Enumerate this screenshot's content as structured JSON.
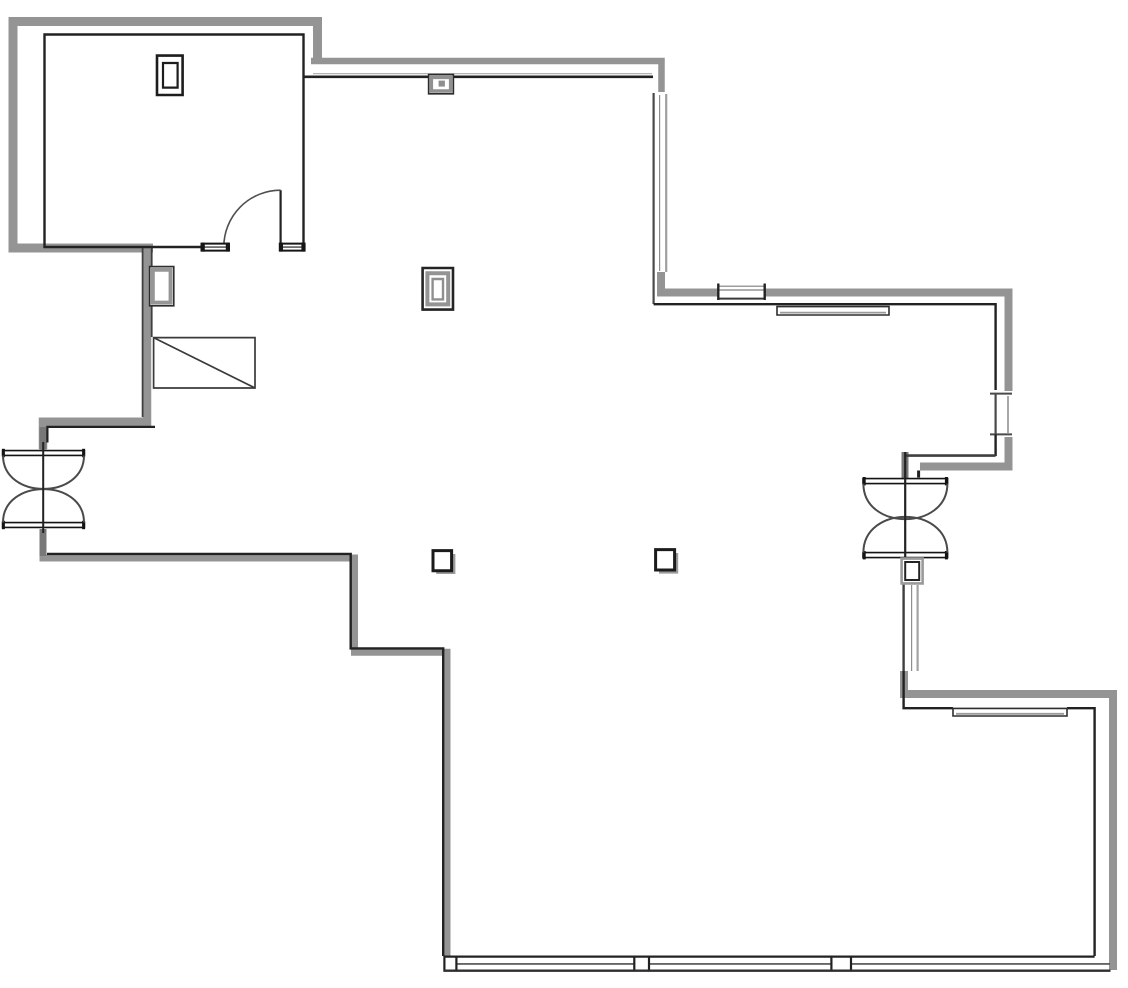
{
  "floorplan": {
    "viewBox": "0 0 1128 988",
    "width": 1128,
    "height": 988,
    "background": "#ffffff",
    "colors": {
      "wall_gray": "#949494",
      "wall_gray_dark": "#787878",
      "line_black": "#222222",
      "line_dark": "#3f3f3f",
      "line_light": "#b3b3b3",
      "shadow_gray": "#9c9c9c",
      "white": "#ffffff"
    },
    "paths": [
      {
        "name": "room-outer-wall-gray",
        "d": "M317.5,59 L317.5,21.5 L13,21.5 L13,248 L153,248",
        "stroke": "#949494",
        "w": 9
      },
      {
        "name": "corridor-top-wall-gray",
        "d": "M311,61 L661.5,61 L661.5,92",
        "stroke": "#949494",
        "w": 6.5
      },
      {
        "name": "window-topright-corner-gray",
        "d": "M661,272 L661,292.5 L718,292.5",
        "stroke": "#949494",
        "w": 8
      },
      {
        "name": "right-upper-band-gray",
        "d": "M765,292.5 L1008.5,292.5 L1008.5,391",
        "stroke": "#949494",
        "w": 8
      },
      {
        "name": "right-mid-corner-gray",
        "d": "M1008.5,437 L1008.5,466.5 L920,466.5",
        "stroke": "#949494",
        "w": 8
      },
      {
        "name": "right-lower-corner-gray",
        "d": "M904,671 L904,694 L1113,694 L1113,970",
        "stroke": "#949494",
        "w": 8
      },
      {
        "name": "left-upper-wall-gray",
        "d": "M147,248 L147,421.7 L43,421.7 L43,449",
        "stroke": "#949494",
        "w": 8.5
      },
      {
        "name": "left-lower-wall-gray",
        "d": "M43,531 L43,558 L354.5,558 L354.5,652.3 L447,652.3 L447,956",
        "stroke": "#949494",
        "w": 7
      },
      {
        "name": "right-door-top-stub-gray",
        "d": "M905,452 L905,478",
        "stroke": "#787878",
        "w": 7
      },
      {
        "name": "left-door-top-stub-gray",
        "d": "M43,427 L43,449.5",
        "stroke": "#787878",
        "w": 7
      },
      {
        "name": "left-door-bottom-stub-gray",
        "d": "M43,529 L43,556",
        "stroke": "#787878",
        "w": 7
      },
      {
        "name": "corridor-inner-light-line",
        "d": "M313,73.6 L652,73.6",
        "stroke": "#b3b3b3",
        "w": 1.3
      },
      {
        "name": "window-topright-line-right",
        "d": "M666.2,94 L666.2,272",
        "stroke": "#9e9e9e",
        "w": 2.2
      },
      {
        "name": "window-topright-line-mid",
        "d": "M659.6,95 L659.6,271",
        "stroke": "#8e8e8e",
        "w": 1.2
      },
      {
        "name": "window-top-line-a",
        "d": "M719,286.2 L765,286.2",
        "stroke": "#7f7f7f",
        "w": 1.2
      },
      {
        "name": "window-top-line-b",
        "d": "M719,290 L765,290",
        "stroke": "#7f7f7f",
        "w": 1.2
      },
      {
        "name": "window-rightmid-line-light",
        "d": "M1008,396 L1008,433",
        "stroke": "#a8a8a8",
        "w": 2
      },
      {
        "name": "window-rightlow-line-right",
        "d": "M917.6,585 L917.6,671",
        "stroke": "#a3a3a3",
        "w": 2.2
      },
      {
        "name": "window-rightlow-line-mid",
        "d": "M911.6,585 L911.6,671",
        "stroke": "#8e8e8e",
        "w": 1.2
      },
      {
        "name": "room-inner-wall-black",
        "d": "M201,247 L44.5,247 L44.5,34.5 L303.5,34.5 L303.5,247",
        "stroke": "#222222",
        "w": 2.4
      },
      {
        "name": "corridor-inner-black-west",
        "d": "M303.5,76.8 L429,76.8",
        "stroke": "#222222",
        "w": 2.6
      },
      {
        "name": "corridor-inner-black-east",
        "d": "M452.5,76.8 L653,76.8",
        "stroke": "#222222",
        "w": 2.6
      },
      {
        "name": "window-topright-line-dark",
        "d": "M653.6,93 L653.6,304",
        "stroke": "#4a4a4a",
        "w": 2.2
      },
      {
        "name": "right-upper-inner-black",
        "d": "M653.6,304.2 L995.6,304.2 L995.6,390",
        "stroke": "#222222",
        "w": 2.4
      },
      {
        "name": "window-top-line-bottom",
        "d": "M718,298.6 L765,298.6",
        "stroke": "#3a3a3a",
        "w": 2
      },
      {
        "name": "window-top-cap-left",
        "d": "M718.3,283.5 L718.3,300",
        "stroke": "#222222",
        "w": 2.4
      },
      {
        "name": "window-top-cap-right",
        "d": "M764.7,283.5 L764.7,300",
        "stroke": "#222222",
        "w": 2.4
      },
      {
        "name": "window-rightmid-line-dark",
        "d": "M995.6,394 L995.6,434",
        "stroke": "#4a4a4a",
        "w": 2.2
      },
      {
        "name": "window-rightmid-cap-top",
        "d": "M990,393.6 L1012,393.6",
        "stroke": "#4a4a4a",
        "w": 2
      },
      {
        "name": "window-rightmid-cap-bottom",
        "d": "M990,434.4 L1012,434.4",
        "stroke": "#4a4a4a",
        "w": 2
      },
      {
        "name": "window-rightmid-lower-black",
        "d": "M995.6,434.4 L995.6,456",
        "stroke": "#222222",
        "w": 2.4
      },
      {
        "name": "right-mid-inner-dark",
        "d": "M905,455.6 L995.6,455.6",
        "stroke": "#3f3f3f",
        "w": 2.6
      },
      {
        "name": "right-door-jamb-tick",
        "d": "M918.6,470.5 L918.6,477.5",
        "stroke": "#222222",
        "w": 3
      },
      {
        "name": "window-rightlow-line-dark",
        "d": "M903.6,584 L903.6,671",
        "stroke": "#3f3f3f",
        "w": 2.4
      },
      {
        "name": "bottomright-inner-black-west",
        "d": "M903.6,671 L903.6,708.2 L953,708.2",
        "stroke": "#222222",
        "w": 2.4
      },
      {
        "name": "bottomright-inner-black-east",
        "d": "M1067,708.2 L1094.6,708.2 L1094.6,956",
        "stroke": "#222222",
        "w": 2.4
      },
      {
        "name": "left-lower-inner-black",
        "d": "M47,553.9 L350.7,553.9 L350.7,648.4 L443.2,648.4 L443.2,956",
        "stroke": "#222222",
        "w": 2.4
      },
      {
        "name": "left-jog-inner-black",
        "d": "M155,426.9 L47.4,426.9 L47.4,442.5",
        "stroke": "#222222",
        "w": 2.2
      },
      {
        "name": "left-wall-west-edge",
        "d": "M142.6,248 L142.6,417",
        "stroke": "#3f3f3f",
        "w": 1.8
      },
      {
        "name": "left-wall-east-edge",
        "d": "M151.7,248 L151.7,337",
        "stroke": "#3f3f3f",
        "w": 1.8
      },
      {
        "name": "storefront-mid-line",
        "d": "M444,963.9 L1110,963.9",
        "stroke": "#4f4f4f",
        "w": 1.6
      },
      {
        "name": "storefront-post-1-fill",
        "d": "M444.5,957.5 L456.3,957.5 L456.3,969.6 L444.5,969.6 Z",
        "stroke": "none",
        "w": 0,
        "fill": "#ffffff"
      },
      {
        "name": "storefront-post-1-left",
        "d": "M444.4,955.7 L444.4,971.6",
        "stroke": "#222222",
        "w": 2.2
      },
      {
        "name": "storefront-post-1-right",
        "d": "M456.4,955.7 L456.4,971.6",
        "stroke": "#222222",
        "w": 2.2
      },
      {
        "name": "storefront-post-2-fill",
        "d": "M634.3,957.5 L649,957.5 L649,969.6 L634.3,969.6 Z",
        "stroke": "none",
        "w": 0,
        "fill": "#ffffff"
      },
      {
        "name": "storefront-post-2-left",
        "d": "M634.3,955.7 L634.3,971.6",
        "stroke": "#222222",
        "w": 2.2
      },
      {
        "name": "storefront-post-2-right",
        "d": "M649,955.7 L649,971.6",
        "stroke": "#222222",
        "w": 2.2
      },
      {
        "name": "storefront-post-3-fill",
        "d": "M831.4,957.5 L851,957.5 L851,969.6 L831.4,969.6 Z",
        "stroke": "none",
        "w": 0,
        "fill": "#ffffff"
      },
      {
        "name": "storefront-post-3-left",
        "d": "M831.4,955.7 L831.4,971.6",
        "stroke": "#222222",
        "w": 2.2
      },
      {
        "name": "storefront-post-3-right",
        "d": "M851,955.7 L851,971.6",
        "stroke": "#222222",
        "w": 2.2
      },
      {
        "name": "storefront-top-line",
        "d": "M443.5,956.6 L1094.6,956.6",
        "stroke": "#222222",
        "w": 2.3
      },
      {
        "name": "storefront-bottom-line",
        "d": "M443.5,970.7 L1110.5,970.7",
        "stroke": "#2e2e2e",
        "w": 2.3
      },
      {
        "name": "sill-topright-rect",
        "d": "M777,306.6 L889,306.6 L889,315 L777,315 Z",
        "stroke": "#2e2e2e",
        "w": 1.6,
        "fill": "#ffffff"
      },
      {
        "name": "sill-topright-inner-line",
        "d": "M780,312.6 L886,312.6",
        "stroke": "#9a9a9a",
        "w": 1.8
      },
      {
        "name": "sill-bottomright-rect",
        "d": "M953,708.4 L1067,708.4 L1067,716 L953,716 Z",
        "stroke": "#2e2e2e",
        "w": 1.6,
        "fill": "#ffffff"
      },
      {
        "name": "sill-bottomright-inner-line",
        "d": "M956,713.8 L1064,713.8",
        "stroke": "#9a9a9a",
        "w": 1.8
      },
      {
        "name": "room-door-leaf",
        "d": "M280.6,190.2 L280.6,247",
        "stroke": "#222222",
        "w": 2.2
      },
      {
        "name": "room-door-swing-arc",
        "d": "M280.6,190.2 A56.8,56.8 0 0 0 223.8,247",
        "stroke": "#4f4f4f",
        "w": 1.6
      },
      {
        "name": "room-door-sill-left-rect",
        "d": "M201.5,243.6 L229,243.6 L229,250.6 L201.5,250.6 Z",
        "stroke": "#161616",
        "w": 2,
        "fill": "#ffffff"
      },
      {
        "name": "room-door-sill-left-mid",
        "d": "M201.5,247.1 L229,247.1",
        "stroke": "#161616",
        "w": 1.1
      },
      {
        "name": "room-door-sill-left-cap-a",
        "d": "M203.2,242.6 L203.2,251.6",
        "stroke": "#161616",
        "w": 3.2
      },
      {
        "name": "room-door-sill-left-cap-b",
        "d": "M227.4,242.6 L227.4,251.6",
        "stroke": "#161616",
        "w": 3.2
      },
      {
        "name": "room-door-sill-right-rect",
        "d": "M279.8,243.6 L304.6,243.6 L304.6,250.6 L279.8,250.6 Z",
        "stroke": "#161616",
        "w": 2,
        "fill": "#ffffff"
      },
      {
        "name": "room-door-sill-right-mid",
        "d": "M279.8,247.1 L304.6,247.1",
        "stroke": "#161616",
        "w": 1.1
      },
      {
        "name": "room-door-sill-right-cap-a",
        "d": "M281.4,242.6 L281.4,251.6",
        "stroke": "#161616",
        "w": 3.2
      },
      {
        "name": "room-door-sill-right-cap-b",
        "d": "M303,242.6 L303,251.6",
        "stroke": "#161616",
        "w": 3.2
      },
      {
        "name": "room-fixture-outer-rect",
        "d": "M157,55.6 L182.6,55.6 L182.6,95 L157,95 Z",
        "stroke": "#1d1d1d",
        "w": 2.6,
        "fill": "#ffffff"
      },
      {
        "name": "room-fixture-inner-rect",
        "d": "M163,63 L177.6,63 L177.6,87.6 L163,87.6 Z",
        "stroke": "#1d1d1d",
        "w": 2.2
      },
      {
        "name": "topwall-box-outer",
        "d": "M428.6,74.6 L453.4,74.6 L453.4,93.8 L428.6,93.8 Z",
        "stroke": "#2b2b2b",
        "w": 1.6,
        "fill": "#ffffff"
      },
      {
        "name": "topwall-box-gray-ring",
        "d": "M431.4,77.4 L450.6,77.4 L450.6,91 L431.4,91 Z",
        "stroke": "#919191",
        "w": 3.4
      },
      {
        "name": "topwall-box-dot",
        "d": "M438.6,80.6 L444.9,80.6 L444.9,86.6 L438.6,86.6 Z",
        "stroke": "none",
        "w": 0,
        "fill": "#8f8f8f"
      },
      {
        "name": "leftwall-fixture-outer",
        "d": "M149.6,266.6 L173.8,266.6 L173.8,305.8 L149.6,305.8 Z",
        "stroke": "#2e2e2e",
        "w": 1.6,
        "fill": "#ffffff"
      },
      {
        "name": "leftwall-fixture-gray-ring",
        "d": "M152.8,269.8 L170.6,269.8 L170.6,302.6 L152.8,302.6 Z",
        "stroke": "#969696",
        "w": 4
      },
      {
        "name": "ramp-rect",
        "d": "M153.6,337.6 L255,337.6 L255,388 L153.6,388 Z",
        "stroke": "#3a3a3a",
        "w": 1.7,
        "fill": "#ffffff"
      },
      {
        "name": "ramp-diagonal",
        "d": "M153.6,337.6 L255,388",
        "stroke": "#3a3a3a",
        "w": 1.7
      },
      {
        "name": "center-fixture-outer",
        "d": "M422.6,268 L453,268 L453,309.6 L422.6,309.6 Z",
        "stroke": "#242424",
        "w": 2.6,
        "fill": "#ffffff"
      },
      {
        "name": "center-fixture-gray-ring",
        "d": "M427.4,273.2 L448.2,273.2 L448.2,304.4 L427.4,304.4 Z",
        "stroke": "#949494",
        "w": 4
      },
      {
        "name": "center-fixture-inner",
        "d": "M432.6,279 L443,279 L443,299.4 L432.6,299.4 Z",
        "stroke": "#8f8f8f",
        "w": 2.4,
        "fill": "#ffffff"
      },
      {
        "name": "column-1-shadow",
        "d": "M436.2,554 L455.4,554 L455.4,574 L436.2,574 Z",
        "stroke": "none",
        "w": 0,
        "fill": "#9c9c9c"
      },
      {
        "name": "column-1",
        "d": "M433,550.6 L451.6,550.6 L451.6,570.8 L433,570.8 Z",
        "stroke": "#1b1b1b",
        "w": 3,
        "fill": "#ffffff"
      },
      {
        "name": "column-2-shadow",
        "d": "M659,553 L678.2,553 L678.2,573.6 L659,573.6 Z",
        "stroke": "none",
        "w": 0,
        "fill": "#9c9c9c"
      },
      {
        "name": "column-2",
        "d": "M655.6,549.6 L674.6,549.6 L674.6,570 L655.6,570 Z",
        "stroke": "#1b1b1b",
        "w": 3,
        "fill": "#ffffff"
      },
      {
        "name": "left-entry-door-bar-top",
        "d": "M2.6,450.6 L84.4,450.6 L84.4,455.4 L2.6,455.4 Z",
        "stroke": "#141414",
        "w": 1.6,
        "fill": "#ffffff"
      },
      {
        "name": "left-entry-door-bar-top-cap-a",
        "d": "M3.4,448.8 L3.4,457.2",
        "stroke": "#141414",
        "w": 3
      },
      {
        "name": "left-entry-door-bar-top-cap-b",
        "d": "M83.6,448.8 L83.6,457.2",
        "stroke": "#141414",
        "w": 3
      },
      {
        "name": "left-entry-door-bar-bottom",
        "d": "M2.6,522.6 L84.4,522.6 L84.4,527.4 L2.6,527.4 Z",
        "stroke": "#141414",
        "w": 1.6,
        "fill": "#ffffff"
      },
      {
        "name": "left-entry-door-bar-bottom-cap-a",
        "d": "M3.4,520.8 L3.4,529.2",
        "stroke": "#141414",
        "w": 3
      },
      {
        "name": "left-entry-door-bar-bottom-cap-b",
        "d": "M83.6,520.8 L83.6,529.2",
        "stroke": "#141414",
        "w": 3
      },
      {
        "name": "left-entry-door-arc-top",
        "d": "M3,455.5 C3,500 84,500 84,455.5",
        "stroke": "#4a4a4a",
        "w": 2
      },
      {
        "name": "left-entry-door-arc-bottom",
        "d": "M3,522.5 C3,478 84,478 84,522.5",
        "stroke": "#4a4a4a",
        "w": 2
      },
      {
        "name": "left-entry-door-center-line",
        "d": "M43.2,442 L43.2,533",
        "stroke": "#222222",
        "w": 2
      },
      {
        "name": "right-entry-door-bar-top",
        "d": "M863,478.6 L947.6,478.6 L947.6,483.6 L863,483.6 Z",
        "stroke": "#141414",
        "w": 1.6,
        "fill": "#ffffff"
      },
      {
        "name": "right-entry-door-bar-top-cap-a",
        "d": "M864.2,477 L864.2,485.4",
        "stroke": "#141414",
        "w": 3
      },
      {
        "name": "right-entry-door-bar-top-cap-b",
        "d": "M946.4,477 L946.4,485.4",
        "stroke": "#141414",
        "w": 3
      },
      {
        "name": "right-entry-door-bar-bottom",
        "d": "M863,552.6 L947.6,552.6 L947.6,557.6 L863,557.6 Z",
        "stroke": "#141414",
        "w": 1.6,
        "fill": "#ffffff"
      },
      {
        "name": "right-entry-door-bar-bottom-cap-a",
        "d": "M864.2,551 L864.2,559.4",
        "stroke": "#141414",
        "w": 3
      },
      {
        "name": "right-entry-door-bar-bottom-cap-b",
        "d": "M946.4,551 L946.4,559.4",
        "stroke": "#141414",
        "w": 3
      },
      {
        "name": "right-entry-door-arc-top",
        "d": "M863.4,483.6 C863.4,531 947.4,531 947.4,483.6",
        "stroke": "#4a4a4a",
        "w": 2
      },
      {
        "name": "right-entry-door-arc-bottom",
        "d": "M863.4,552.6 C863.4,505 947.4,505 947.4,552.6",
        "stroke": "#4a4a4a",
        "w": 2
      },
      {
        "name": "right-entry-door-center-line",
        "d": "M905.2,452 L905.2,583",
        "stroke": "#222222",
        "w": 2.2
      },
      {
        "name": "right-door-jamb-outer",
        "d": "M901.6,558.6 L922.6,558.6 L922.6,583.4 L901.6,583.4 Z",
        "stroke": "#9a9a9a",
        "w": 2.6,
        "fill": "#ffffff"
      },
      {
        "name": "right-door-jamb-inner",
        "d": "M905.2,562 L919.2,562 L919.2,580 L905.2,580 Z",
        "stroke": "#232323",
        "w": 2,
        "fill": "#ffffff"
      }
    ]
  }
}
